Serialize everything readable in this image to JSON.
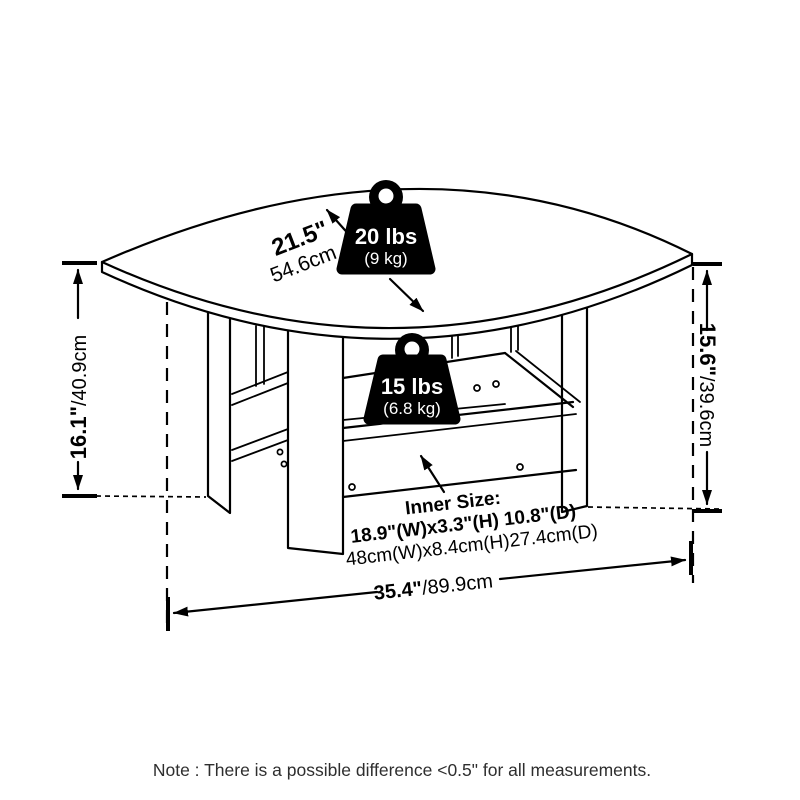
{
  "colors": {
    "line": "#000000",
    "background": "#ffffff",
    "weight_fill": "#000000",
    "weight_text": "#ffffff",
    "note_text": "#2e2e2e"
  },
  "dimensions": {
    "height_left": {
      "inches": "16.1\"",
      "cm": "/40.9cm"
    },
    "height_right": {
      "inches": "15.6\"",
      "cm": "/39.6cm"
    },
    "width": {
      "inches": "35.4\"",
      "cm": "/89.9cm"
    },
    "depth": {
      "inches": "21.5\"",
      "cm": "54.6cm"
    }
  },
  "load_ratings": {
    "tabletop": {
      "icon": "weight-icon",
      "pounds": "20 lbs",
      "kilograms": "(9 kg)"
    },
    "shelf": {
      "icon": "weight-icon",
      "pounds": "15 lbs",
      "kilograms": "(6.8 kg)"
    }
  },
  "inner_size": {
    "title": "Inner Size:",
    "imperial": "18.9\"(W)x3.3\"(H) 10.8\"(D)",
    "metric": "48cm(W)x8.4cm(H)27.4cm(D)"
  },
  "note": "Note : There is a possible difference <0.5\" for all measurements."
}
